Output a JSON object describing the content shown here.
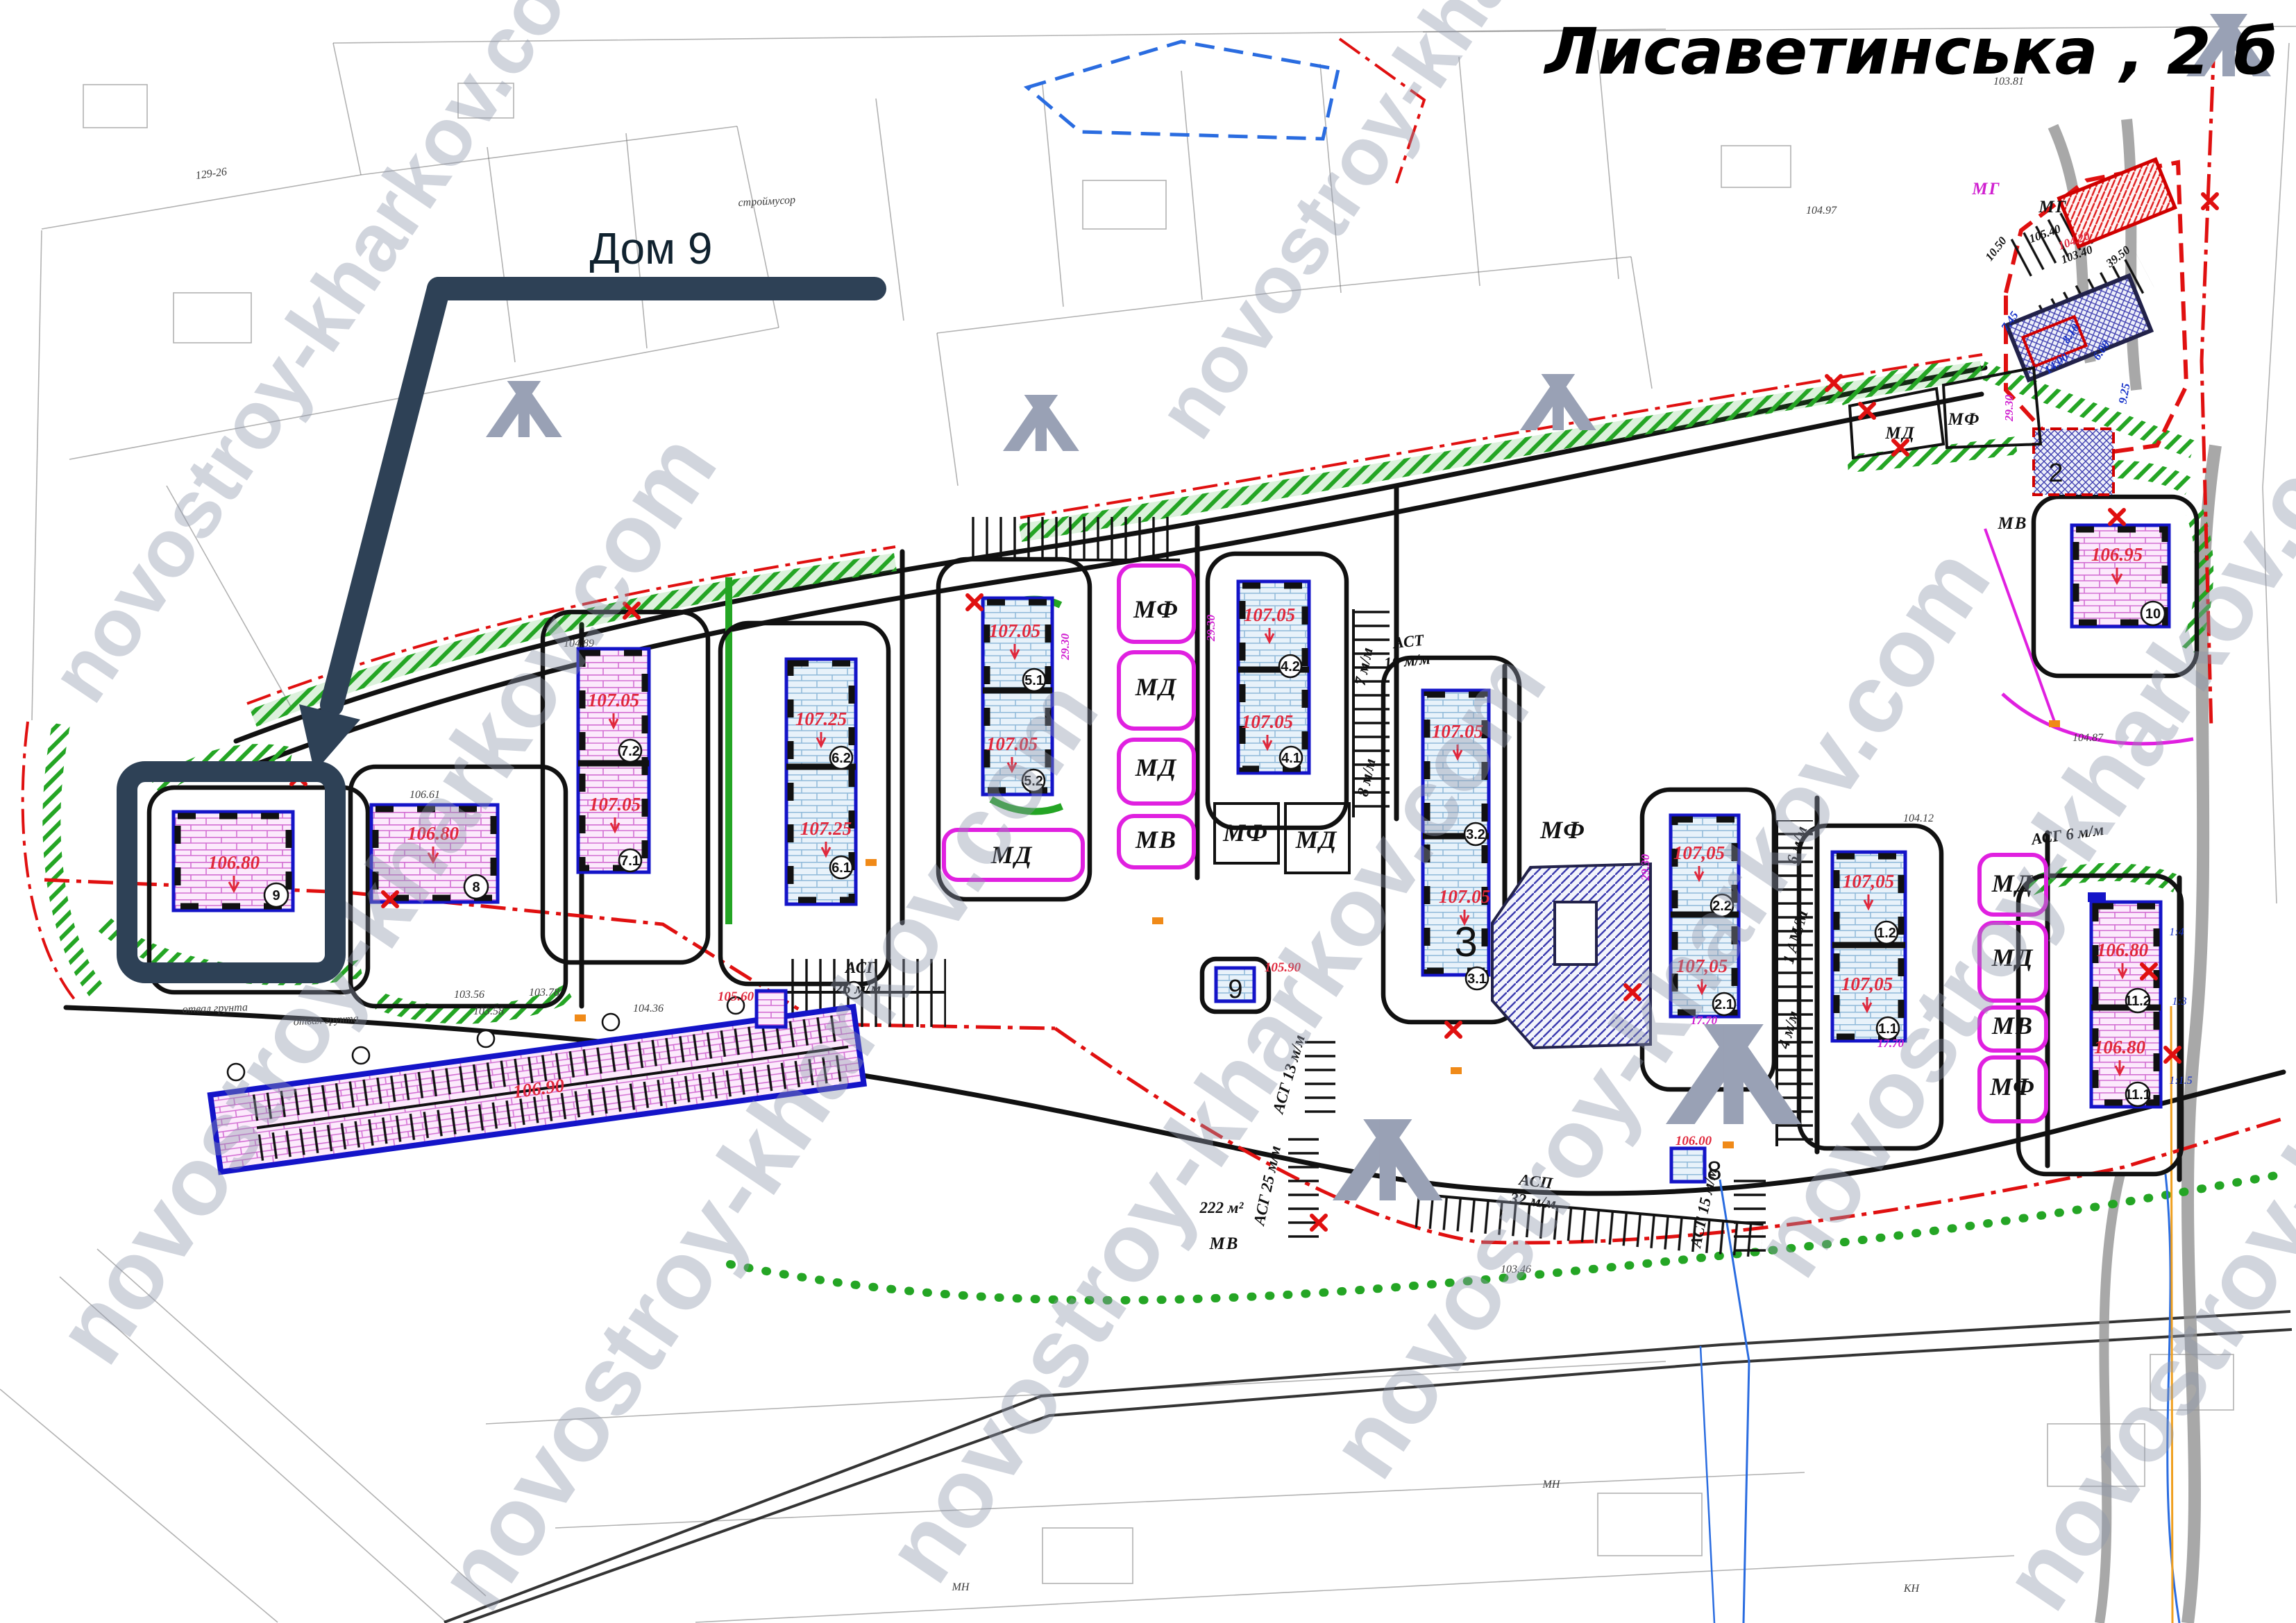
{
  "title": "Лисаветинська , 2 б",
  "callout_label": "Дом 9",
  "watermark": "novostroy-kharkov.com",
  "colors": {
    "highlight_navy": "#2e4156",
    "building_outline_blue": "#1414c8",
    "pink_building_fill": "#fceafc",
    "blue_building_fill": "#e8f2fa",
    "boundary_green": "#24a524",
    "zone_magenta": "#e020e0",
    "line_red": "#e01010",
    "elevation_red": "#e0283c",
    "watermark_gray": "#8f97ab"
  },
  "buildings": {
    "b9": {
      "num": "9",
      "elev": "106.80"
    },
    "b8": {
      "num": "8",
      "elev": "106.80"
    },
    "b7": {
      "top_num": "7.2",
      "top_elev": "107.05",
      "bot_num": "7.1",
      "bot_elev": "107.05"
    },
    "b6": {
      "top_num": "6.2",
      "top_elev": "107.25",
      "bot_num": "6.1",
      "bot_elev": "107.25"
    },
    "b5": {
      "top_num": "5.1",
      "top_elev": "107.05",
      "bot_num": "5.2",
      "bot_elev": "107.05"
    },
    "b4": {
      "top_num": "4.2",
      "top_elev": "107.05",
      "bot_num": "4.1",
      "bot_elev": "107.05"
    },
    "b3": {
      "top_num": "3.2",
      "top_elev": "107.05",
      "bot_num": "3.1",
      "bot_elev": "107.05",
      "big_num": "3"
    },
    "b2": {
      "top_num": "2.2",
      "top_elev": "107,05",
      "bot_num": "2.1",
      "bot_elev": "107,05"
    },
    "b1": {
      "top_num": "1.2",
      "top_elev": "107,05",
      "bot_num": "1.1",
      "bot_elev": "107,05"
    },
    "b11": {
      "top_num": "11.2",
      "top_elev": "106.80",
      "bot_num": "11.1",
      "bot_elev": "106.80"
    },
    "b10": {
      "num": "10",
      "elev": "106.95"
    },
    "garage": {
      "elev": "106.90"
    },
    "tp9": {
      "num": "9",
      "elev": "105.90"
    },
    "tp8": {
      "num": "8",
      "elev": "106.00"
    },
    "tp_small": {
      "elev": "105.60"
    },
    "site2": {
      "num": "2"
    }
  },
  "zones": [
    "МФ",
    "МД",
    "МД",
    "МВ",
    "МД",
    "МФ",
    "МД",
    "МД",
    "МД",
    "МВ",
    "МФ",
    "МД",
    "МФ",
    "МВ",
    "МГ",
    "МВ",
    "МФ",
    "МГ"
  ],
  "parking": [
    "АСТ",
    "10 м/м",
    "7 м/м",
    "8 м/м",
    "6 м/м",
    "1 АМ/М",
    "4 м/м",
    "АСГ 6 м/м",
    "АСП",
    "32 м/м",
    "АСГ 15 м/м",
    "АСГ 25 м/м",
    "222 м²",
    "АСГ",
    "26 м/м",
    "АСГ 13 м/м"
  ],
  "dims": [
    "10.50",
    "39.50",
    "103.40",
    "104.20",
    "105.40",
    "7.45",
    "14.00",
    "8.10",
    "6.00",
    "9.25",
    "17.70",
    "17.70",
    "29.30",
    "29.30",
    "29.30",
    "29.30"
  ],
  "survey": [
    "129-26",
    "строймусор",
    "отвал грунта",
    "отвал грунта",
    "103.56",
    "103.58",
    "103.78",
    "104.36",
    "106.61",
    "104.89",
    "104.97",
    "103.81",
    "104.12",
    "103.46",
    "104.87",
    "1:4",
    "1:3",
    "1:1.5",
    "МН",
    "КН",
    "МН"
  ]
}
